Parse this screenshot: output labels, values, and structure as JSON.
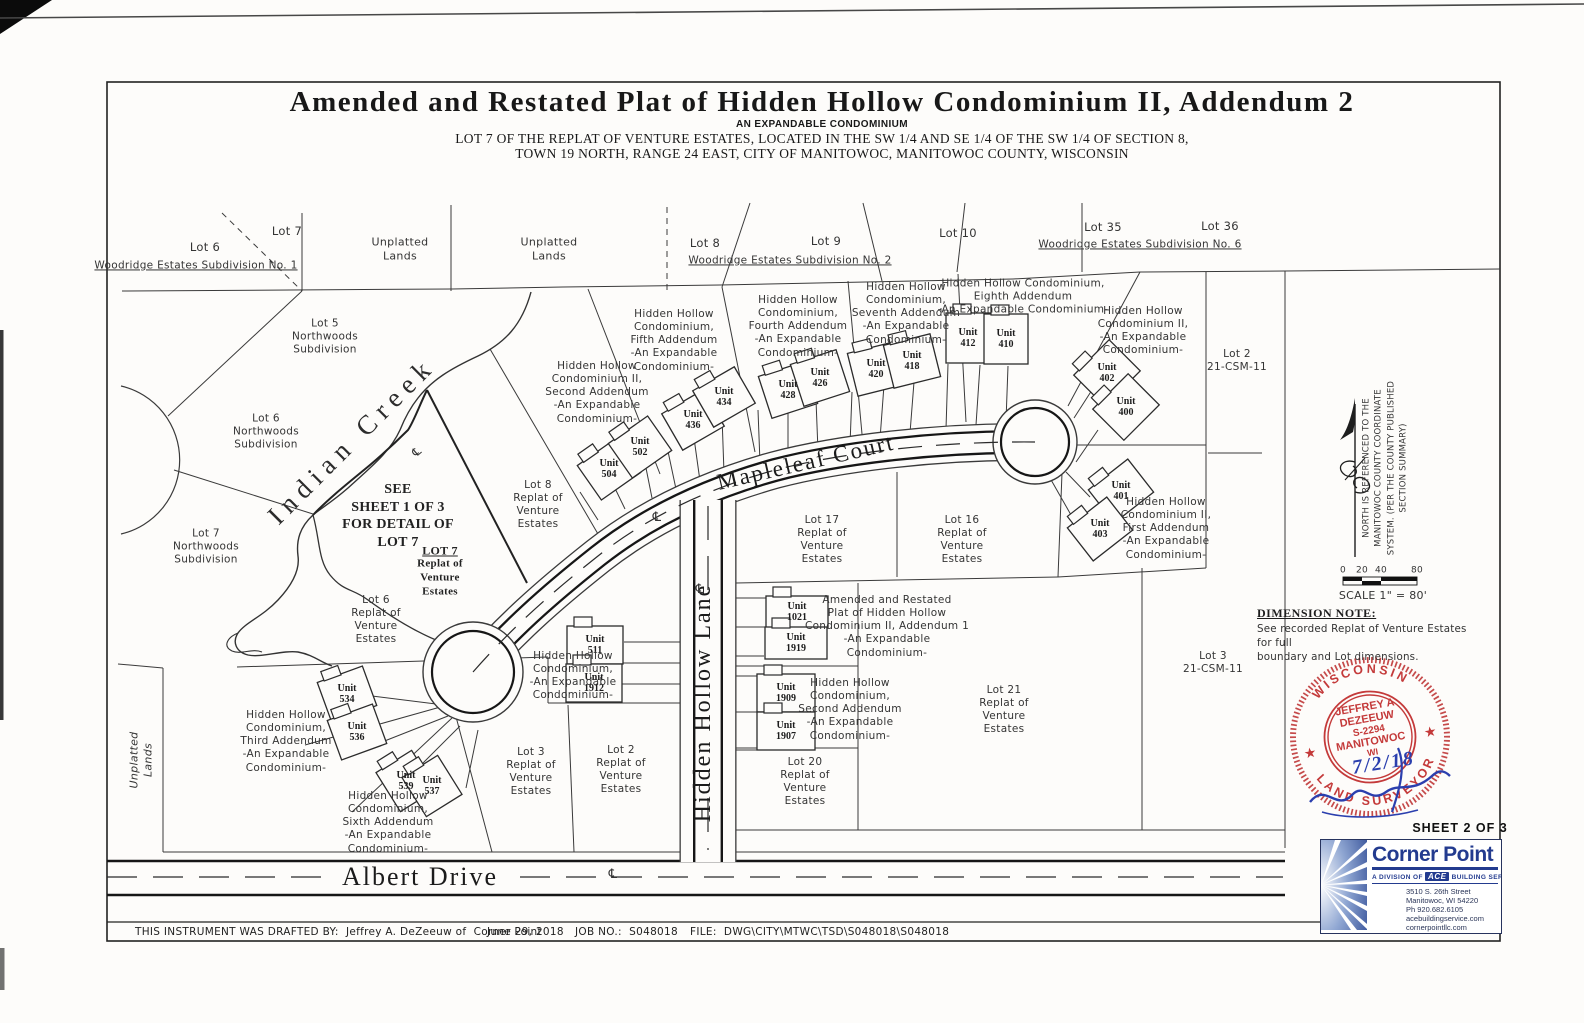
{
  "title": {
    "main": "Amended and Restated Plat of Hidden Hollow Condominium II, Addendum 2",
    "sub1": "AN EXPANDABLE CONDOMINIUM",
    "sub2": "LOT 7 OF THE REPLAT OF VENTURE ESTATES, LOCATED IN THE SW 1/4 AND SE 1/4 OF THE SW 1/4 OF SECTION 8,",
    "sub3": "TOWN 19 NORTH, RANGE 24 EAST, CITY OF MANITOWOC, MANITOWOC COUNTY, WISCONSIN"
  },
  "icons": {
    "star": "★",
    "centerline": "℄"
  },
  "notes": {
    "dimension_title": "DIMENSION NOTE:",
    "dimension_body": "See recorded Replat of Venture Estates for full\nboundary and Lot dimensions."
  },
  "stamp": {
    "arc_top": "WISCONSIN",
    "arc_bottom": "LAND SURVEYOR",
    "lines": [
      "JEFFREY A",
      "DEZEEUW",
      "S-2294",
      "MANITOWOC",
      "WI"
    ],
    "date": "7/2/18"
  },
  "sheet_label": "SHEET 2 OF 3",
  "logo": {
    "name": "Corner Point",
    "division_prefix": "A DIVISION OF",
    "division_badge": "ACE",
    "division_suffix": "BUILDING SERVICE",
    "address": [
      "3510 S. 26th Street",
      "Manitowoc, WI 54220",
      "Ph 920.682.6105",
      "acebuildingservice.com",
      "cornerpointllc.com"
    ]
  },
  "footer": {
    "drafted": "THIS INSTRUMENT WAS DRAFTED BY:  Jeffrey A. DeZeeuw of  Corner Point",
    "date": "June 29, 2018",
    "job": "JOB NO.:  S048018",
    "file": "FILE:  DWG\\CITY\\MTWC\\TSD\\S048018\\S048018"
  },
  "map": {
    "labels": [
      {
        "id": "lot6-woodridge-label",
        "text": "Lot 6",
        "x": 205,
        "y": 247,
        "size": 11.5
      },
      {
        "id": "woodridge-no1-label",
        "text": "Woodridge Estates Subdivision No. 1",
        "x": 196,
        "y": 266,
        "cls": "u",
        "size": 10.5
      },
      {
        "id": "lot7-woodridge-label",
        "text": "Lot 7",
        "x": 287,
        "y": 231,
        "size": 11.5
      },
      {
        "id": "unplatted-lands-label-1",
        "text": "Unplatted\nLands",
        "x": 400,
        "y": 249,
        "size": 11
      },
      {
        "id": "unplatted-lands-label-2",
        "text": "Unplatted\nLands",
        "x": 549,
        "y": 249,
        "size": 11
      },
      {
        "id": "lot8-woodridge-label",
        "text": "Lot 8",
        "x": 705,
        "y": 243,
        "size": 11.5
      },
      {
        "id": "lot9-woodridge-label",
        "text": "Lot 9",
        "x": 826,
        "y": 241,
        "size": 11.5
      },
      {
        "id": "woodridge-no2-label",
        "text": "Woodridge Estates Subdivision No. 2",
        "x": 790,
        "y": 261,
        "cls": "u",
        "size": 10.5
      },
      {
        "id": "lot10-label",
        "text": "Lot 10",
        "x": 958,
        "y": 233,
        "size": 11.5
      },
      {
        "id": "lot35-label",
        "text": "Lot 35",
        "x": 1103,
        "y": 227,
        "size": 11.5
      },
      {
        "id": "lot36-label",
        "text": "Lot 36",
        "x": 1220,
        "y": 226,
        "size": 11.5
      },
      {
        "id": "woodridge-no6-label",
        "text": "Woodridge Estates Subdivision No. 6",
        "x": 1140,
        "y": 245,
        "cls": "u",
        "size": 10.5
      },
      {
        "id": "lot5-northwoods-label",
        "text": "Lot 5\nNorthwoods\nSubdivision",
        "x": 325,
        "y": 337
      },
      {
        "id": "lot6-northwoods-label",
        "text": "Lot 6\nNorthwoods\nSubdivision",
        "x": 266,
        "y": 432
      },
      {
        "id": "lot7-northwoods-label",
        "text": "Lot 7\nNorthwoods\nSubdivision",
        "x": 206,
        "y": 547
      },
      {
        "id": "indian-creek-label",
        "text": "Indian Creek",
        "x": 352,
        "y": 441,
        "cls": "creek",
        "rot": -45
      },
      {
        "id": "hh2-second-addendum-label",
        "text": "Hidden Hollow\nCondominium II,\nSecond Addendum\n-An Expandable\nCondominium-",
        "x": 597,
        "y": 393
      },
      {
        "id": "hh-fifth-addendum-label",
        "text": "Hidden Hollow\nCondominium,\nFifth Addendum\n-An Expandable\nCondominium-",
        "x": 674,
        "y": 341
      },
      {
        "id": "hh-fourth-addendum-label",
        "text": "Hidden Hollow\nCondominium,\nFourth Addendum\n-An Expandable\nCondominium-",
        "x": 798,
        "y": 327
      },
      {
        "id": "hh-seventh-addendum-label",
        "text": "Hidden Hollow\nCondominium,\nSeventh Addendum\n-An Expandable\nCondominium-",
        "x": 906,
        "y": 314
      },
      {
        "id": "hh-eighth-addendum-label",
        "text": "Hidden Hollow Condominium,\nEighth Addendum\n-An Expandable Condominium-",
        "x": 1023,
        "y": 297
      },
      {
        "id": "hh2-expandable-label",
        "text": "Hidden Hollow\nCondominium II,\n-An Expandable\nCondominium-",
        "x": 1143,
        "y": 331
      },
      {
        "id": "lot2-csm-label",
        "text": "Lot 2\n21-CSM-11",
        "x": 1237,
        "y": 361
      },
      {
        "id": "hh2-first-addendum-label",
        "text": "Hidden Hollow\nCondominium II,\nFirst Addendum\n-An Expandable\nCondominium-",
        "x": 1166,
        "y": 529
      },
      {
        "id": "lot3-csm-label",
        "text": "Lot 3\n21-CSM-11",
        "x": 1213,
        "y": 663
      },
      {
        "id": "see-sheet-note",
        "text": "SEE\nSHEET 1 OF 3\nFOR DETAIL OF\nLOT 7",
        "x": 398,
        "y": 516,
        "cls": "sb",
        "size": 14
      },
      {
        "id": "lot7-replat-title",
        "text": "LOT 7",
        "x": 440,
        "y": 551,
        "cls": "sb u",
        "size": 12
      },
      {
        "id": "lot7-replat-label",
        "text": "Replat of\nVenture\nEstates",
        "x": 440,
        "y": 578,
        "cls": "sb",
        "size": 11
      },
      {
        "id": "lot8-replat-label",
        "text": "Lot 8\nReplat of\nVenture\nEstates",
        "x": 538,
        "y": 505
      },
      {
        "id": "lot6-replat-label",
        "text": "Lot 6\nReplat of\nVenture\nEstates",
        "x": 376,
        "y": 620
      },
      {
        "id": "lot17-replat-label",
        "text": "Lot 17\nReplat of\nVenture\nEstates",
        "x": 822,
        "y": 540
      },
      {
        "id": "lot16-replat-label",
        "text": "Lot 16\nReplat of\nVenture\nEstates",
        "x": 962,
        "y": 540
      },
      {
        "id": "amended-addendum1-label",
        "text": "Amended and Restated\nPlat of Hidden Hollow\nCondominium II, Addendum 1\n-An Expandable\nCondominium-",
        "x": 887,
        "y": 627
      },
      {
        "id": "hh-second-addendum-label",
        "text": "Hidden Hollow\nCondominium,\nSecond Addendum\n-An Expandable\nCondominium-",
        "x": 850,
        "y": 710
      },
      {
        "id": "lot21-replat-label",
        "text": "Lot 21\nReplat of\nVenture\nEstates",
        "x": 1004,
        "y": 710
      },
      {
        "id": "lot20-replat-label",
        "text": "Lot 20\nReplat of\nVenture\nEstates",
        "x": 805,
        "y": 782
      },
      {
        "id": "lot3-replat-label",
        "text": "Lot 3\nReplat of\nVenture\nEstates",
        "x": 531,
        "y": 772
      },
      {
        "id": "lot2-replat-label",
        "text": "Lot 2\nReplat of\nVenture\nEstates",
        "x": 621,
        "y": 770
      },
      {
        "id": "hh-third-addendum-label",
        "text": "Hidden Hollow\nCondominium,\nThird Addendum\n-An Expandable\nCondominium-",
        "x": 286,
        "y": 742
      },
      {
        "id": "hh-sixth-addendum-label",
        "text": "Hidden Hollow\nCondominium,\nSixth Addendum\n-An Expandable\nCondominium-",
        "x": 388,
        "y": 823
      },
      {
        "id": "hh-expandable-label",
        "text": "Hidden Hollow\nCondominium,\n-An Expandable\nCondominium-",
        "x": 573,
        "y": 676
      },
      {
        "id": "unplatted-lands-vertical-label",
        "text": "Unplatted\nLands",
        "x": 141,
        "y": 760,
        "rot": -90,
        "cls": "it",
        "size": 11
      },
      {
        "id": "mapleleaf-court-label",
        "text": "Mapleleaf Court",
        "x": 806,
        "y": 463,
        "cls": "st",
        "rot": -13,
        "size": 23
      },
      {
        "id": "hidden-hollow-lane-label",
        "text": "Hidden Hollow Lane",
        "x": 703,
        "y": 703,
        "cls": "st",
        "rot": -90,
        "size": 24
      },
      {
        "id": "albert-drive-label",
        "text": "Albert Drive",
        "x": 420,
        "y": 877,
        "cls": "st",
        "size": 26
      },
      {
        "id": "centerline-symbol-mapleleaf",
        "text": "℄",
        "x": 657,
        "y": 518,
        "size": 13
      },
      {
        "id": "centerline-symbol-hidden-hollow",
        "text": "℄",
        "x": 700,
        "y": 590,
        "size": 13
      },
      {
        "id": "centerline-symbol-albert",
        "text": "℄",
        "x": 613,
        "y": 875,
        "size": 13
      },
      {
        "id": "centerline-symbol-creek",
        "text": "℄",
        "x": 417,
        "y": 452,
        "size": 12,
        "rot": -40
      },
      {
        "id": "scale-tick-0",
        "text": "0",
        "x": 1343,
        "y": 571,
        "size": 9
      },
      {
        "id": "scale-tick-20",
        "text": "20",
        "x": 1362,
        "y": 571,
        "size": 9
      },
      {
        "id": "scale-tick-40",
        "text": "40",
        "x": 1381,
        "y": 571,
        "size": 9
      },
      {
        "id": "scale-tick-80",
        "text": "80",
        "x": 1417,
        "y": 571,
        "size": 9
      },
      {
        "id": "scale-text",
        "text": "SCALE 1\" = 80'",
        "x": 1383,
        "y": 596,
        "size": 11
      },
      {
        "id": "north-note",
        "text": "NORTH IS REFERENCED TO THE\nMANITOWOC COUNTY COORDINATE\nSYSTEM. (PER THE COUNTY PUBLISHED\nSECTION SUMMARY)",
        "x": 1385,
        "y": 468,
        "rot": -90,
        "size": 8.5,
        "cls": "tl"
      }
    ],
    "units": [
      {
        "label": "Unit\n504",
        "x": 609,
        "y": 469,
        "rot": -35,
        "w": 48,
        "h": 42
      },
      {
        "label": "Unit\n502",
        "x": 640,
        "y": 447,
        "rot": -35,
        "w": 48,
        "h": 42
      },
      {
        "label": "Unit\n436",
        "x": 693,
        "y": 420,
        "rot": -30,
        "w": 48,
        "h": 42
      },
      {
        "label": "Unit\n434",
        "x": 724,
        "y": 397,
        "rot": -30,
        "w": 48,
        "h": 42
      },
      {
        "label": "Unit\n428",
        "x": 788,
        "y": 390,
        "rot": -18,
        "w": 48,
        "h": 44
      },
      {
        "label": "Unit\n426",
        "x": 820,
        "y": 378,
        "rot": -18,
        "w": 48,
        "h": 44
      },
      {
        "label": "Unit\n420",
        "x": 876,
        "y": 369,
        "rot": -14,
        "w": 48,
        "h": 44
      },
      {
        "label": "Unit\n418",
        "x": 912,
        "y": 361,
        "rot": -14,
        "w": 48,
        "h": 44
      },
      {
        "label": "Unit\n412",
        "x": 968,
        "y": 338,
        "rot": 0,
        "w": 44,
        "h": 50
      },
      {
        "label": "Unit\n410",
        "x": 1006,
        "y": 339,
        "rot": 0,
        "w": 44,
        "h": 50
      },
      {
        "label": "Unit\n402",
        "x": 1107,
        "y": 373,
        "rot": -45,
        "w": 50,
        "h": 44
      },
      {
        "label": "Unit\n400",
        "x": 1126,
        "y": 407,
        "rot": -45,
        "w": 50,
        "h": 44
      },
      {
        "label": "Unit\n401",
        "x": 1121,
        "y": 491,
        "rot": -38,
        "w": 50,
        "h": 42
      },
      {
        "label": "Unit\n403",
        "x": 1100,
        "y": 529,
        "rot": -38,
        "w": 50,
        "h": 42
      },
      {
        "label": "Unit\n534",
        "x": 347,
        "y": 694,
        "rot": -20,
        "w": 48,
        "h": 42
      },
      {
        "label": "Unit\n536",
        "x": 357,
        "y": 732,
        "rot": -20,
        "w": 48,
        "h": 42
      },
      {
        "label": "Unit\n539",
        "x": 406,
        "y": 781,
        "rot": -32,
        "w": 42,
        "h": 46
      },
      {
        "label": "Unit\n537",
        "x": 432,
        "y": 786,
        "rot": -32,
        "w": 42,
        "h": 46
      },
      {
        "label": "Unit\n511",
        "x": 595,
        "y": 645,
        "rot": 0,
        "w": 56,
        "h": 38
      },
      {
        "label": "Unit\n1912",
        "x": 594,
        "y": 683,
        "rot": 0,
        "w": 56,
        "h": 38
      },
      {
        "label": "Unit\n1021",
        "x": 797,
        "y": 612,
        "rot": 0,
        "w": 62,
        "h": 32
      },
      {
        "label": "Unit\n1919",
        "x": 796,
        "y": 643,
        "rot": 0,
        "w": 62,
        "h": 32
      },
      {
        "label": "Unit\n1909",
        "x": 786,
        "y": 693,
        "rot": 0,
        "w": 58,
        "h": 38
      },
      {
        "label": "Unit\n1907",
        "x": 786,
        "y": 731,
        "rot": 0,
        "w": 58,
        "h": 38
      }
    ]
  }
}
